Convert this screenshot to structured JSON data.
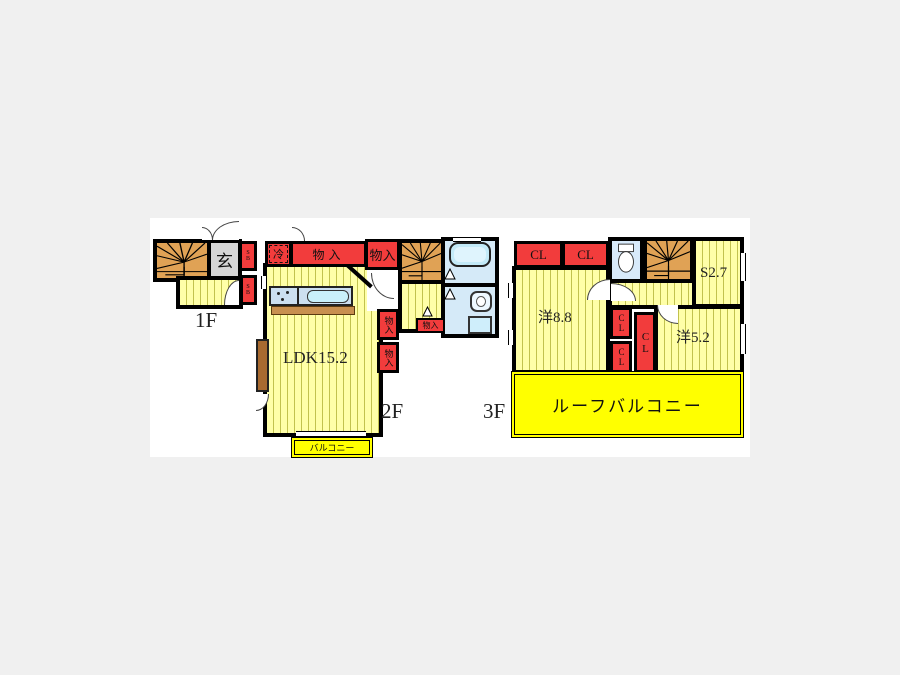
{
  "colors": {
    "background": "#f0f0f0",
    "canvas": "#ffffff",
    "wall": "#000000",
    "floor_yellow": "#ffffa8",
    "floor_stripe": "#c2c24e",
    "closet_red": "#f23c3c",
    "stair_orange": "#e0a255",
    "bath_blue": "#d5eaf8",
    "balcony_yellow": "#ffff00",
    "genkan_gray": "#d6d6d6",
    "counter_brown": "#c89050",
    "bay_brown": "#a86a30"
  },
  "floor1": {
    "label": "1F",
    "genkan": "玄",
    "shoe_box_upper": "SB",
    "shoe_box_lower": "SB"
  },
  "floor2": {
    "label": "2F",
    "ldk": "LDK15.2",
    "fridge": "冷",
    "closet_top": "物入",
    "closet_upper_right": "物入",
    "closet_mid_upper": "物入",
    "closet_mid_lower": "物入",
    "closet_hall": "物入",
    "balcony": "バルコニー"
  },
  "floor3": {
    "label": "3F",
    "closet_left": "CL",
    "closet_right": "CL",
    "room_west_88": "洋8.8",
    "service_room": "S2.7",
    "room_west_52": "洋5.2",
    "closet_center_upper": "CL",
    "closet_center_lower": "CL",
    "closet_center_tall": "CL",
    "roof_balcony": "ルーフバルコニー"
  }
}
